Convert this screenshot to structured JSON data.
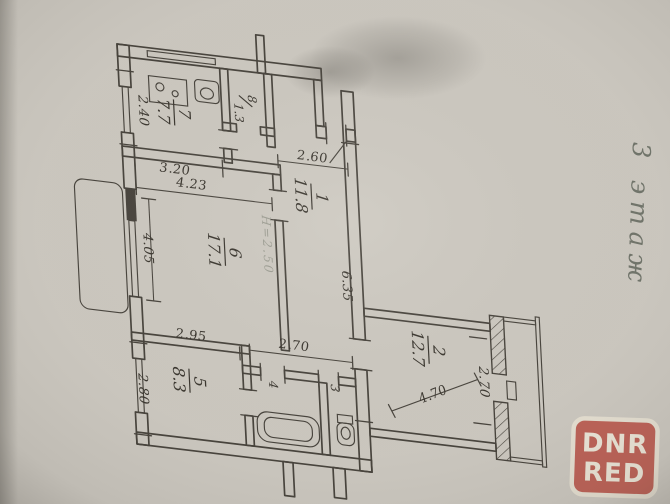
{
  "page": {
    "floor_note": "3 этаж"
  },
  "watermark": {
    "line1": "DNR",
    "line2": "RED"
  },
  "rooms": [
    {
      "number": "1",
      "area": "11.8"
    },
    {
      "number": "2",
      "area": "12.7"
    },
    {
      "number": "3"
    },
    {
      "number": "4"
    },
    {
      "number": "5",
      "area": "8.3"
    },
    {
      "number": "6",
      "area": "17.1"
    },
    {
      "number": "7",
      "area": "7.7"
    },
    {
      "number": "8",
      "area": "1.3"
    }
  ],
  "dimensions": {
    "kitchen_depth": "2.40",
    "kitchen_width": "3.20",
    "entry_width": "2.60",
    "room6_width": "4.23",
    "room6_depth": "4.05",
    "ceiling_height": "H=2.50",
    "corridor_length": "6.35",
    "room5_width": "2.95",
    "room5_depth": "2.80",
    "hall_width": "2.70",
    "room2_width": "2.70",
    "room2_length": "4.70"
  },
  "colors": {
    "ink": "#46423b",
    "paper": "#ccc8c0",
    "watermark_red": "#bd6156",
    "pencil_gray": "#70746a"
  }
}
